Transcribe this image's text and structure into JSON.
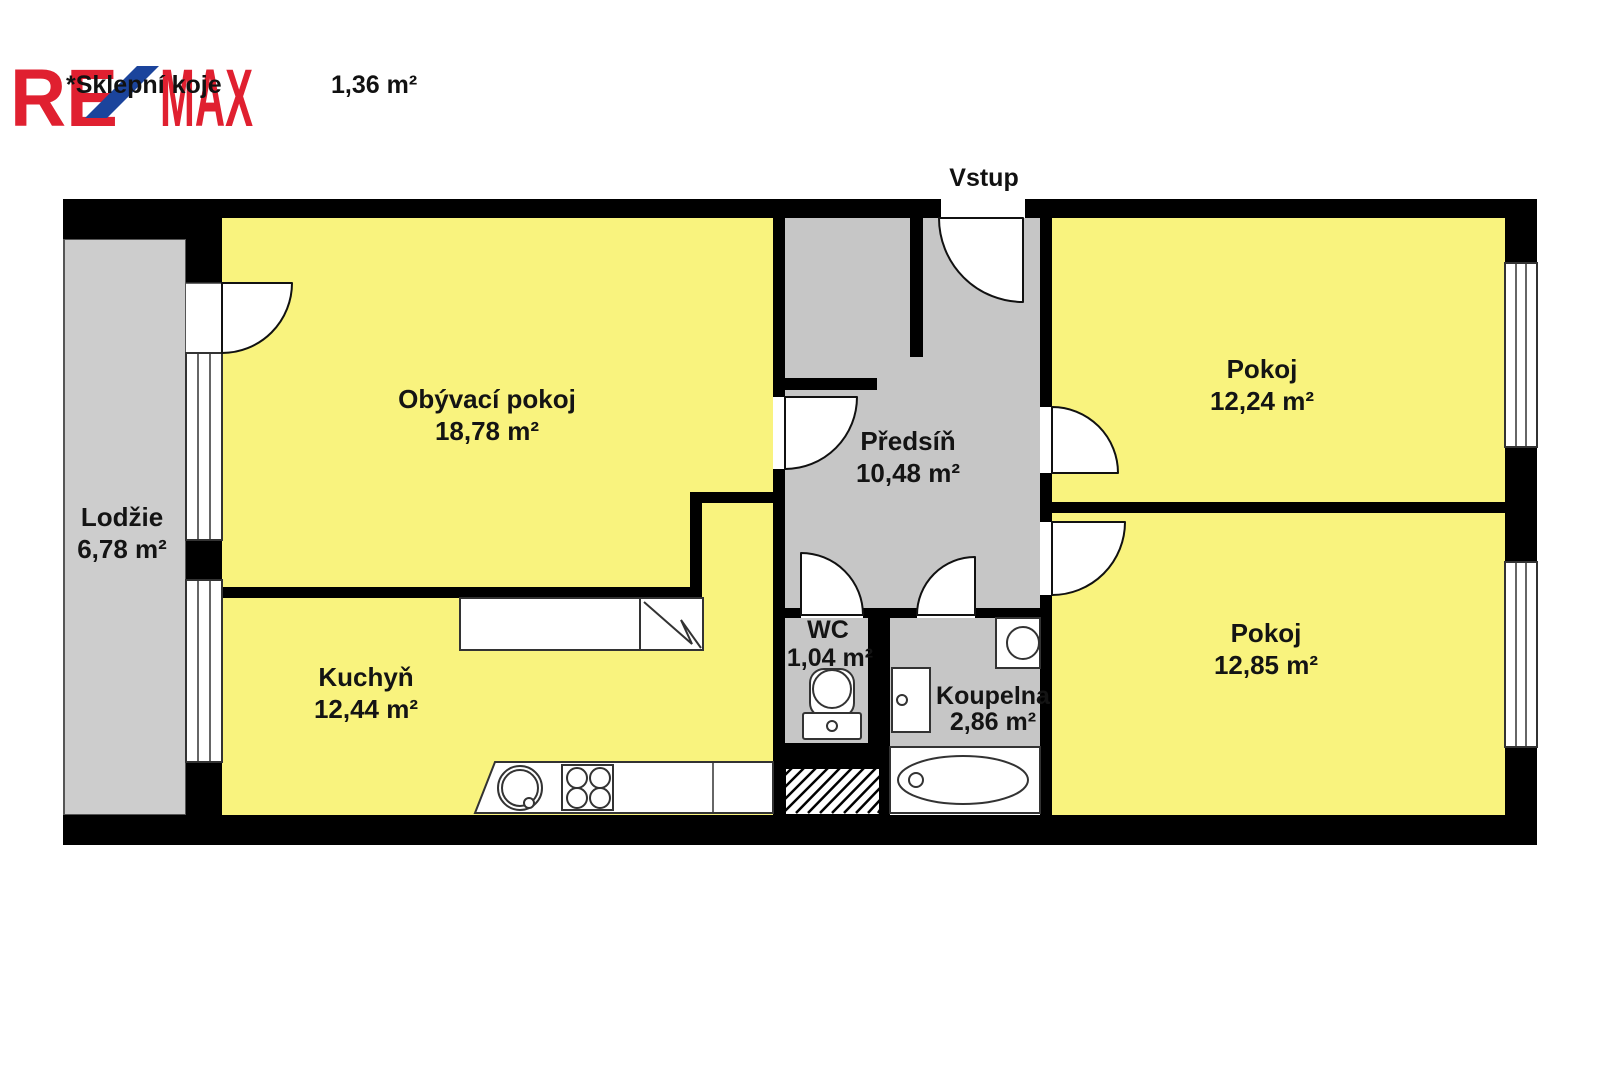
{
  "header": {
    "brand": {
      "re": "RE",
      "max": "MAX"
    },
    "note": "*Sklepní koje",
    "note_area": "1,36 m²",
    "entrance_label": "Vstup"
  },
  "rooms": [
    {
      "id": "living-room",
      "name": "Obývací pokoj",
      "area": "18,78 m²"
    },
    {
      "id": "hallway",
      "name": "Předsíň",
      "area": "10,48 m²"
    },
    {
      "id": "room-top",
      "name": "Pokoj",
      "area": "12,24 m²"
    },
    {
      "id": "room-bottom",
      "name": "Pokoj",
      "area": "12,85 m²"
    },
    {
      "id": "kitchen",
      "name": "Kuchyň",
      "area": "12,44 m²"
    },
    {
      "id": "loggia",
      "name": "Lodžie",
      "area": "6,78 m²"
    },
    {
      "id": "wc",
      "name": "WC",
      "area": "1,04 m²"
    },
    {
      "id": "bathroom",
      "name": "Koupelna",
      "area": "2,86 m²"
    }
  ],
  "icons": [
    "kitchen-sink-icon",
    "stove-icon",
    "refrigerator-icon",
    "counter-icon",
    "toilet-icon",
    "washing-machine-icon",
    "bathroom-sink-icon",
    "bathtub-icon",
    "door-swing-icon",
    "window-icon",
    "shaft-hatch-icon"
  ],
  "colors": {
    "wall": "#000000",
    "room_yellow": "#F9F37E",
    "corridor_gray": "#C6C6C6",
    "loggia_gray": "#CDCDCD",
    "brand_red": "#E02030",
    "brand_blue": "#1B449C"
  }
}
